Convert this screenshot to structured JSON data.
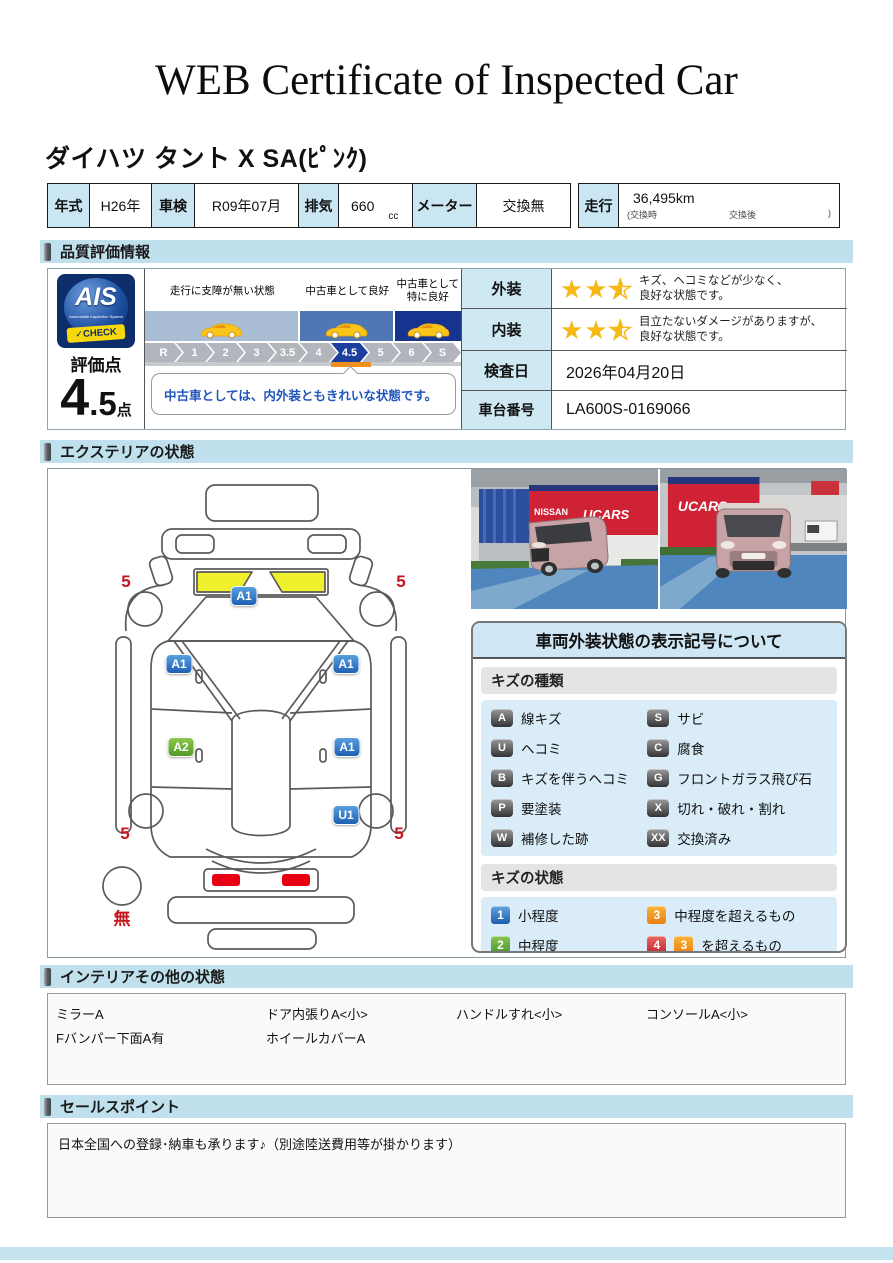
{
  "title": "WEB Certificate of Inspected Car",
  "car_name": "ダイハツ タント X SA(ﾋﾟﾝｸ)",
  "spec": {
    "items": [
      {
        "label": "年式",
        "value": "H26年"
      },
      {
        "label": "車検",
        "value": "R09年07月"
      },
      {
        "label": "排気",
        "value": "660",
        "unit": "cc"
      },
      {
        "label": "メーター",
        "value": "交換無"
      },
      {
        "label": "走行",
        "value": "36,495km",
        "sub_open": "(交換時",
        "sub_mid": "交換後",
        "sub_close": ")"
      }
    ]
  },
  "sections": {
    "quality": "品質評価情報",
    "exterior": "エクステリアの状態",
    "interior": "インテリアその他の状態",
    "sales": "セールスポイント"
  },
  "quality": {
    "logo": {
      "name": "AIS",
      "subtitle": "Automobile Inspection System",
      "check": "CHECK"
    },
    "score_label": "評価点",
    "score_int": "4",
    "score_dec": ".5",
    "score_unit": "点",
    "bands": [
      {
        "label": "走行に支障が無い状態",
        "color": "#a9bdd4",
        "width": 49
      },
      {
        "label": "中古車として良好",
        "color": "#4f77b5",
        "width": 30
      },
      {
        "label": "中古車として\n特に良好",
        "color": "#16338f",
        "width": 21
      }
    ],
    "scale_ticks": [
      "R",
      "1",
      "2",
      "3",
      "3.5",
      "4",
      "4.5",
      "5",
      "6",
      "S"
    ],
    "scale_active": "4.5",
    "comment": "中古車としては、内外装ともきれいな状態です。",
    "rows": [
      {
        "label": "外装",
        "stars": 2.5,
        "line1": "キズ、ヘコミなどが少なく、",
        "line2": "良好な状態です。"
      },
      {
        "label": "内装",
        "stars": 2.5,
        "line1": "目立たないダメージがありますが、",
        "line2": "良好な状態です。"
      },
      {
        "label": "検査日",
        "value": "2026年04月20日"
      },
      {
        "label": "車台番号",
        "value": "LA600S-0169066"
      }
    ]
  },
  "exterior": {
    "markers": [
      {
        "kind": "badge",
        "text": "A1",
        "color": "blue",
        "x": 188,
        "y": 123
      },
      {
        "kind": "badge",
        "text": "A1",
        "color": "blue",
        "x": 123,
        "y": 191
      },
      {
        "kind": "badge",
        "text": "A1",
        "color": "blue",
        "x": 290,
        "y": 191
      },
      {
        "kind": "badge",
        "text": "A2",
        "color": "green",
        "x": 125,
        "y": 274
      },
      {
        "kind": "badge",
        "text": "A1",
        "color": "blue",
        "x": 291,
        "y": 274
      },
      {
        "kind": "badge",
        "text": "U1",
        "color": "blue",
        "x": 290,
        "y": 342
      },
      {
        "kind": "text",
        "text": "5",
        "x": 70,
        "y": 109
      },
      {
        "kind": "text",
        "text": "5",
        "x": 345,
        "y": 109
      },
      {
        "kind": "text",
        "text": "5",
        "x": 69,
        "y": 361
      },
      {
        "kind": "text",
        "text": "5",
        "x": 343,
        "y": 361
      },
      {
        "kind": "text",
        "text": "無",
        "x": 66,
        "y": 444
      }
    ],
    "photos": {
      "banner_nissan": "NISSAN",
      "banner_ucars": "UCARS",
      "banner_ucars_right": "UCARS"
    },
    "legend": {
      "title": "車両外装状態の表示記号について",
      "kind_header": "キズの種類",
      "kinds": [
        {
          "code": "A",
          "label": "線キズ"
        },
        {
          "code": "S",
          "label": "サビ"
        },
        {
          "code": "U",
          "label": "ヘコミ"
        },
        {
          "code": "C",
          "label": "腐食"
        },
        {
          "code": "B",
          "label": "キズを伴うヘコミ"
        },
        {
          "code": "G",
          "label": "フロントガラス飛び石"
        },
        {
          "code": "P",
          "label": "要塗装"
        },
        {
          "code": "X",
          "label": "切れ・破れ・割れ"
        },
        {
          "code": "W",
          "label": "補修した跡"
        },
        {
          "code": "XX",
          "label": "交換済み"
        }
      ],
      "state_header": "キズの状態",
      "states": [
        {
          "badges": [
            {
              "text": "1",
              "color": "blue"
            }
          ],
          "label": "小程度"
        },
        {
          "badges": [
            {
              "text": "3",
              "color": "orange"
            }
          ],
          "label": "中程度を超えるもの"
        },
        {
          "badges": [
            {
              "text": "2",
              "color": "green"
            }
          ],
          "label": "中程度"
        },
        {
          "badges": [
            {
              "text": "4",
              "color": "red"
            },
            {
              "text": "3",
              "color": "orange"
            }
          ],
          "label": "を超えるもの"
        }
      ]
    }
  },
  "interior": {
    "rows": [
      [
        "ミラーA",
        "ドア内張りA<小>",
        "ハンドルすれ<小>",
        "コンソールA<小>"
      ],
      [
        "Fバンパー下面A有",
        "ホイールカバーA",
        "",
        ""
      ]
    ]
  },
  "sales": {
    "text": "日本全国への登録･納車も承ります♪（別途陸送費用等が掛かります）"
  },
  "colors": {
    "section_header": "#bfe0ec",
    "active_tick": "#1c3f9e",
    "star": "#f6b815",
    "marker_blue": "#2e6db8",
    "marker_green": "#6aab32",
    "red_note": "#c4161c",
    "tick_underline": "#f0901c"
  }
}
